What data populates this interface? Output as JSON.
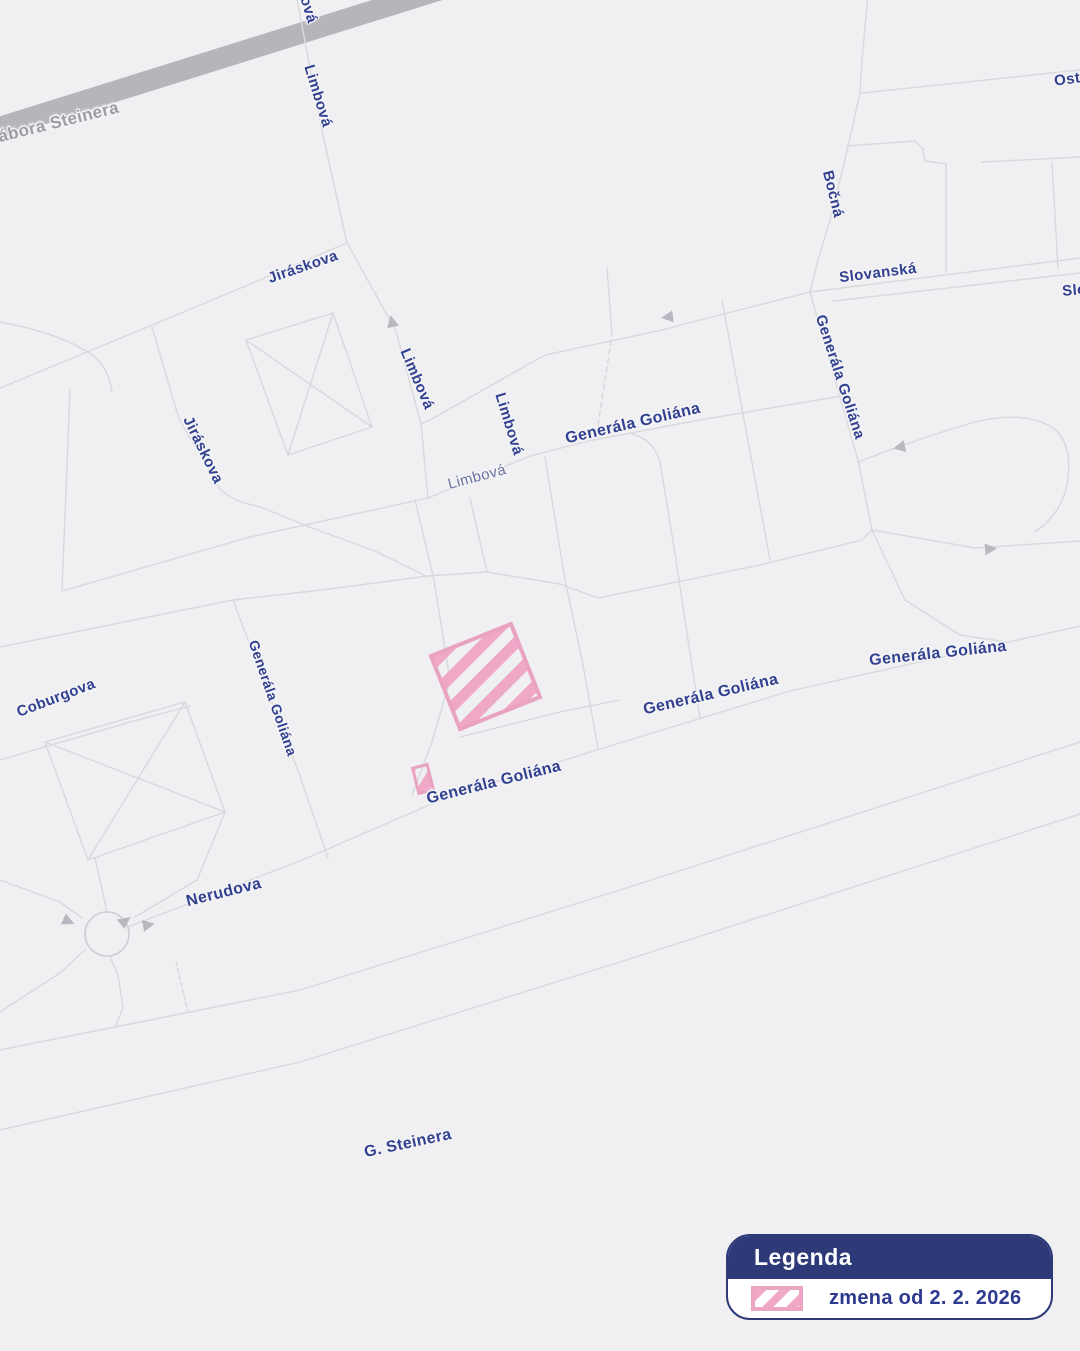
{
  "map": {
    "background_color": "#f0f0f2",
    "street_color": "#d8d8dd",
    "major_road_color": "#b5b5bb",
    "arrow_color": "#b8b8c0",
    "label_color_primary": "#31408f",
    "label_color_muted": "#9c9ca6",
    "label_color_light": "#6a73a3",
    "change_area": {
      "fill_color": "#efa9c6",
      "border_color": "#e9a2c1",
      "pattern": "diagonal-hatch"
    },
    "labels": [
      {
        "name": "gabora-steinera",
        "text": "Gábora Steinera",
        "x": 52,
        "y": 124,
        "rot": -14,
        "size": 17,
        "style": "muted"
      },
      {
        "name": "limbova-top-clipped",
        "text": "Limbová",
        "x": 303,
        "y": -8,
        "rot": 73,
        "size": 15,
        "style": "primary"
      },
      {
        "name": "limbova-upper",
        "text": "Limbová",
        "x": 318,
        "y": 96,
        "rot": 73,
        "size": 15,
        "style": "primary"
      },
      {
        "name": "jiraskova-upper",
        "text": "Jiráskova",
        "x": 303,
        "y": 267,
        "rot": -19,
        "size": 15,
        "style": "primary"
      },
      {
        "name": "jiraskova-left",
        "text": "Jiráskova",
        "x": 203,
        "y": 450,
        "rot": 64,
        "size": 15,
        "style": "primary"
      },
      {
        "name": "limbova-mid-1",
        "text": "Limbová",
        "x": 417,
        "y": 379,
        "rot": 67,
        "size": 15,
        "style": "primary"
      },
      {
        "name": "limbova-mid-2",
        "text": "Limbová",
        "x": 509,
        "y": 424,
        "rot": 73,
        "size": 15,
        "style": "primary"
      },
      {
        "name": "limbova-small",
        "text": "Limbová",
        "x": 477,
        "y": 477,
        "rot": -15,
        "size": 15,
        "style": "light"
      },
      {
        "name": "generala-goliana-center",
        "text": "Generála Goliána",
        "x": 633,
        "y": 424,
        "rot": -13,
        "size": 16,
        "style": "primary"
      },
      {
        "name": "bocna",
        "text": "Bočná",
        "x": 833,
        "y": 194,
        "rot": 76,
        "size": 15,
        "style": "primary"
      },
      {
        "name": "slovanska",
        "text": "Slovanská",
        "x": 878,
        "y": 273,
        "rot": -7,
        "size": 15,
        "style": "primary"
      },
      {
        "name": "ostravska-clipped",
        "text": "Ostravská",
        "x": 1092,
        "y": 76,
        "rot": -8,
        "size": 15,
        "style": "primary"
      },
      {
        "name": "slovanska-clipped",
        "text": "Slovanská",
        "x": 1101,
        "y": 288,
        "rot": -5,
        "size": 15,
        "style": "primary"
      },
      {
        "name": "generala-goliana-right",
        "text": "Generála Goliána",
        "x": 840,
        "y": 377,
        "rot": 72,
        "size": 15,
        "style": "primary"
      },
      {
        "name": "coburgova",
        "text": "Coburgova",
        "x": 56,
        "y": 698,
        "rot": -21,
        "size": 15,
        "style": "primary"
      },
      {
        "name": "generala-goliana-left",
        "text": "Generála Goliána",
        "x": 273,
        "y": 698,
        "rot": 71,
        "size": 14,
        "style": "primary"
      },
      {
        "name": "generala-goliana-road",
        "text": "Generála Goliána",
        "x": 494,
        "y": 783,
        "rot": -14,
        "size": 16,
        "style": "primary"
      },
      {
        "name": "generala-goliana-mid",
        "text": "Generála Goliána",
        "x": 711,
        "y": 695,
        "rot": -13,
        "size": 16,
        "style": "primary"
      },
      {
        "name": "generala-goliana-far",
        "text": "Generála Goliána",
        "x": 938,
        "y": 654,
        "rot": -6,
        "size": 16,
        "style": "primary"
      },
      {
        "name": "nerudova",
        "text": "Nerudova",
        "x": 224,
        "y": 893,
        "rot": -14,
        "size": 16,
        "style": "primary"
      },
      {
        "name": "g-steinera",
        "text": "G. Steinera",
        "x": 408,
        "y": 1144,
        "rot": -12,
        "size": 16,
        "style": "primary"
      }
    ]
  },
  "legend": {
    "title": "Legenda",
    "header_bg": "#2e3a78",
    "items": [
      {
        "swatch": "hatched-pink",
        "label": "zmena od 2. 2. 2026"
      }
    ]
  }
}
